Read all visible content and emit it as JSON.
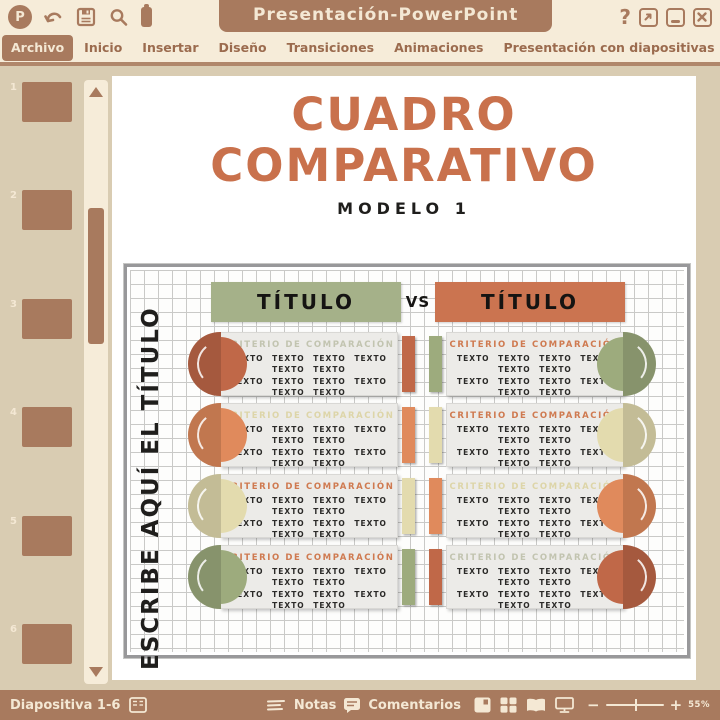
{
  "colors": {
    "brown": "#a87a5e",
    "brown_dark": "#9b6b4e",
    "cream": "#f6ecd9",
    "cream_text": "#f4e8d4",
    "beige": "#d9ccb2",
    "title_orange": "#c9714c",
    "black": "#1f1e1c",
    "chart_border": "#98989a",
    "grid_line": "#c9c9c7",
    "card_bg": "#ecebe8",
    "header_green": "#a5b189",
    "header_orange": "#cb7450",
    "terracotta": "#c06848",
    "orange": "#e08a5c",
    "cream_accent": "#e3dbae",
    "sage": "#9dab7d",
    "heading_orange": "#cf7a50",
    "heading_cream": "#ddd5a8",
    "heading_sage": "#c2c4b0"
  },
  "titlebar": {
    "app_title": "Presentación-PowerPoint",
    "logo_letter": "P",
    "help_label": "?"
  },
  "menubar": {
    "items": [
      {
        "label": "Archivo",
        "active": true
      },
      {
        "label": "Inicio",
        "active": false
      },
      {
        "label": "Insertar",
        "active": false
      },
      {
        "label": "Diseño",
        "active": false
      },
      {
        "label": "Transiciones",
        "active": false
      },
      {
        "label": "Animaciones",
        "active": false
      },
      {
        "label": "Presentación con diapositivas",
        "active": false
      },
      {
        "label": "Revisar",
        "active": false
      },
      {
        "label": "Vista",
        "active": false
      }
    ]
  },
  "sidebar": {
    "slide_numbers": [
      "1",
      "2",
      "3",
      "4",
      "5",
      "6"
    ]
  },
  "slide": {
    "title_line1": "CUADRO",
    "title_line2": "COMPARATIVO",
    "subtitle": "MODELO 1",
    "vertical_label": "ESCRIBE AQUÍ EL TÍTULO",
    "left_title": "TÍTULO",
    "vs_label": "VS",
    "right_title": "TÍTULO",
    "criteria_heading": "CRITERIO DE COMPARACIÓN",
    "card_body_lines": [
      "TEXTO TEXTO TEXTO TEXTO TEXTO TEXTO",
      "TEXTO TEXTO TEXTO TEXTO TEXTO TEXTO",
      "TEXTO TEXTO TEXTO TEXTO TEXTO TEXTO"
    ],
    "rows": [
      {
        "left": {
          "accent": "terracotta",
          "heading_color": "heading_sage"
        },
        "right": {
          "accent": "sage",
          "heading_color": "heading_orange"
        }
      },
      {
        "left": {
          "accent": "orange",
          "heading_color": "heading_cream"
        },
        "right": {
          "accent": "cream_accent",
          "heading_color": "heading_orange"
        }
      },
      {
        "left": {
          "accent": "cream_accent",
          "heading_color": "heading_orange"
        },
        "right": {
          "accent": "orange",
          "heading_color": "heading_cream"
        }
      },
      {
        "left": {
          "accent": "sage",
          "heading_color": "heading_orange"
        },
        "right": {
          "accent": "terracotta",
          "heading_color": "heading_sage"
        }
      }
    ]
  },
  "statusbar": {
    "slide_label": "Diapositiva 1-6",
    "notes_label": "Notas",
    "comments_label": "Comentarios",
    "zoom_percent": "55%"
  }
}
